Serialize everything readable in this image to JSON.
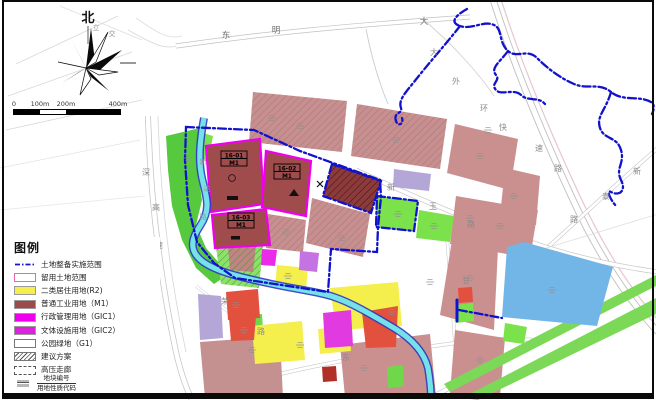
{
  "compass": {
    "north_label": "北"
  },
  "scalebar": {
    "labels": [
      "0",
      "100m",
      "200m",
      "400m"
    ]
  },
  "legend": {
    "title": "图例",
    "items": [
      {
        "label": "土地整备实施范围",
        "swatch": "dashdot-line",
        "color": "#1414cc"
      },
      {
        "label": "留用土地范围",
        "swatch": "outline-box",
        "color": "#e868b0"
      },
      {
        "label": "二类居住用地(R2)",
        "swatch": "fill",
        "color": "#f4ef4d"
      },
      {
        "label": "普通工业用地（M1）",
        "swatch": "fill",
        "color": "#9c4a4a"
      },
      {
        "label": "行政管理用地（GIC1）",
        "swatch": "fill",
        "color": "#ee00ee"
      },
      {
        "label": "文体设施用地（GIC2）",
        "swatch": "fill",
        "color": "#dd22dd"
      },
      {
        "label": "公园绿地（G1）",
        "swatch": "outline-box-white",
        "color": "#ffffff"
      },
      {
        "label": "建议方案",
        "swatch": "hatch",
        "color": "#555555"
      },
      {
        "label": "高压走廊",
        "swatch": "dashed-box",
        "color": "#555555"
      },
      {
        "label": "地块编号",
        "label2": "用地性质代码",
        "swatch": "plot-code",
        "color": "#888888"
      }
    ]
  },
  "plots": [
    {
      "id": "16-01",
      "code": "M1"
    },
    {
      "id": "16-02",
      "code": "M1"
    },
    {
      "id": "16-03",
      "code": "M1"
    }
  ],
  "road_chars": [
    "东",
    "明",
    "大",
    "立",
    "交",
    "大",
    "外",
    "环",
    "快",
    "速",
    "路",
    "新",
    "泰",
    "路",
    "深",
    "高",
    "速",
    "新",
    "玉",
    "路",
    "荣",
    "路",
    "东",
    "甘",
    "新",
    "达",
    "路"
  ],
  "colors": {
    "boundary_line": "#1212cc",
    "river": "#74e2e6",
    "river_edge": "#2b38c4",
    "water_body": "#72b6e8",
    "residential_r2": "#f4ef4d",
    "industrial_m1": "#a04c4c",
    "reserved_outline": "#ee00ee",
    "existing_block": "#c78f8f",
    "park_green": "#7ce24b",
    "road_gray": "#c6c6c6"
  }
}
